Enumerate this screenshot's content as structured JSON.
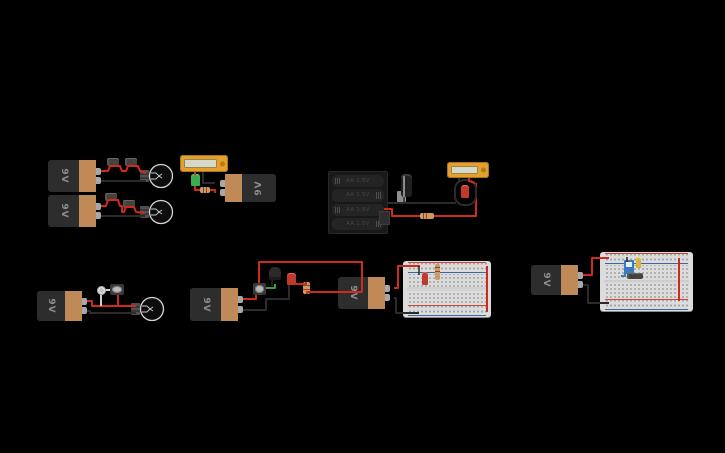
{
  "canvas": {
    "width": 725,
    "height": 453,
    "background": "#000000"
  },
  "labels": {
    "battery_9v": "9V",
    "aa_cell": "AA 1.5V"
  },
  "colors": {
    "wire_red": "#cf2a1e",
    "wire_black": "#2b2b2b",
    "wire_green": "#3f9b3f",
    "wire_white": "#cfcfcf",
    "wire_blue": "#3a79c0",
    "battery_body": "#2d2d2d",
    "battery_band": "#bf8a58",
    "multimeter_body": "#e3a02f",
    "multimeter_screen": "#d6d8ca",
    "breadboard": "#dcdcdc",
    "led_red": "#c0392b",
    "led_green": "#3cab4e",
    "led_yellow": "#d9b43a",
    "switch_blue": "#3a79c0"
  },
  "circuits": [
    {
      "id": "c1",
      "parts": [
        "9v-battery",
        "resistor",
        "resistor",
        "lightbulb"
      ]
    },
    {
      "id": "c2",
      "parts": [
        "9v-battery",
        "resistor",
        "resistor",
        "lightbulb"
      ]
    },
    {
      "id": "c3",
      "parts": [
        "multimeter",
        "green-led",
        "resistor",
        "9v-battery"
      ]
    },
    {
      "id": "c4",
      "parts": [
        "4xAA-battery-holder",
        "electrolytic-capacitor",
        "resistor",
        "red-led",
        "multimeter"
      ]
    },
    {
      "id": "c5",
      "parts": [
        "9v-battery",
        "pushbutton",
        "slide-switch",
        "lightbulb"
      ]
    },
    {
      "id": "c6",
      "parts": [
        "9v-battery",
        "pushbutton",
        "transistor",
        "red-led",
        "resistor"
      ]
    },
    {
      "id": "c7",
      "parts": [
        "9v-battery",
        "breadboard",
        "red-led",
        "resistor"
      ]
    },
    {
      "id": "c8",
      "parts": [
        "9v-battery",
        "breadboard",
        "slide-switch",
        "yellow-led",
        "resistor"
      ]
    }
  ]
}
